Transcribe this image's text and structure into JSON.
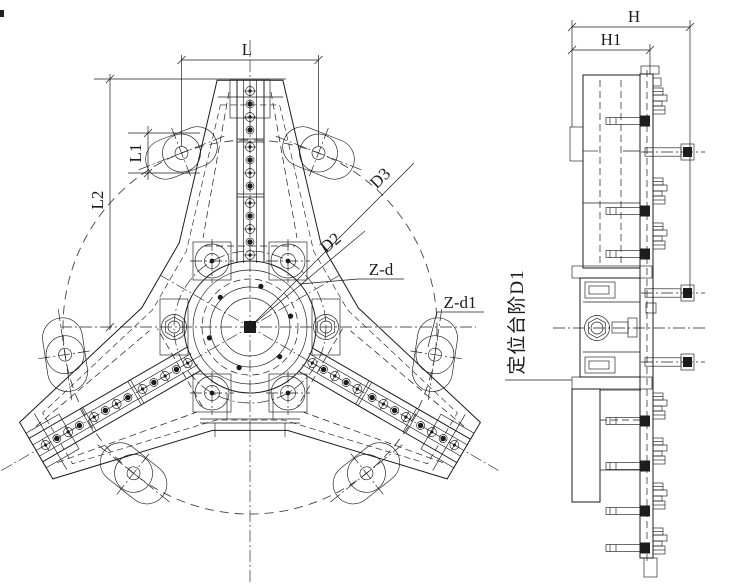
{
  "drawing": {
    "front_view": {
      "dim_width_label": "L",
      "dim_ear_label": "L1",
      "dim_height_label": "L2",
      "dim_bolt_circle_label": "D2",
      "dim_outer_circle_label": "D3",
      "holes_callout": "Z-d",
      "ear_holes_callout": "Z-d1"
    },
    "side_view": {
      "dim_overall_label": "H",
      "dim_plate_label": "H1",
      "positioning_step_note": "定位台阶D1"
    },
    "colors": {
      "line": "#1c1c1c",
      "background": "#ffffff"
    }
  }
}
